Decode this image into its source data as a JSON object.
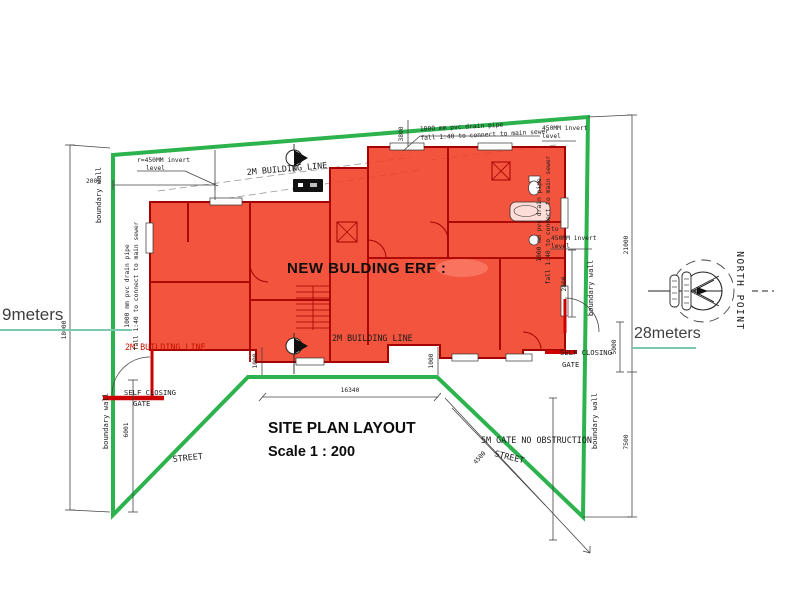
{
  "plan": {
    "building_label": "NEW BULDING ERF :",
    "title": "SITE PLAN LAYOUT",
    "scale": "Scale 1 : 200",
    "street_left": "STREET",
    "street_right": "STREET",
    "gate_note": "5M GATE NO OBSTRUCTION",
    "self_closing_left_1": "SELF CLOSING",
    "self_closing_left_2": "GATE",
    "self_closing_right_1": "SELF CLOSING",
    "self_closing_right_2": "GATE",
    "building_line_top": "2M BUILDING LINE",
    "building_line_bottom": "2M BUILDING LINE",
    "building_line_left": "2M BUILDING LINE",
    "boundary_wall_left_upper": "boundary wall",
    "boundary_wall_left_lower": "boundary wall",
    "boundary_wall_right_upper": "boundary wall",
    "boundary_wall_right_lower": "boundary wall",
    "north_point": "NORTH POINT"
  },
  "drainage": {
    "top_line1": "1000 mm pvc drain pipe",
    "top_line2": "fall 1:40 to connect to main sewer",
    "left_line1": "1000 mm pvc drain pipe",
    "left_line2": "fall 1:40 to connect to main sewer",
    "right_line1": "1000 mm pvc drain pipe",
    "right_line2": "fall 1:40 to connect to main sewer",
    "invert_top_left_1": "r=450MM invert",
    "invert_top_left_2": "level",
    "invert_top_right_1": "450MM invert",
    "invert_top_right_2": "level",
    "invert_right_1": "to",
    "invert_right_2": "450MM invert",
    "invert_right_3": "level"
  },
  "dimensions": {
    "left_height": "18000",
    "left_top": "2000",
    "left_gate": "6001",
    "right_upper": "21000",
    "right_gate": "5000",
    "right_lower": "7500",
    "right_building": "2800",
    "top_building": "3800",
    "bottom_left_offset": "1000",
    "bottom_right_offset": "1000",
    "bottom_width": "16340",
    "street_diagonal": "4500"
  },
  "annotations": {
    "left_measure": "9meters",
    "right_measure": "28meters"
  },
  "colors": {
    "boundary_green": "#2db34d",
    "building_fill": "#f13c23",
    "wall_red": "#a50000",
    "underline_teal": "#7cc7b0"
  }
}
